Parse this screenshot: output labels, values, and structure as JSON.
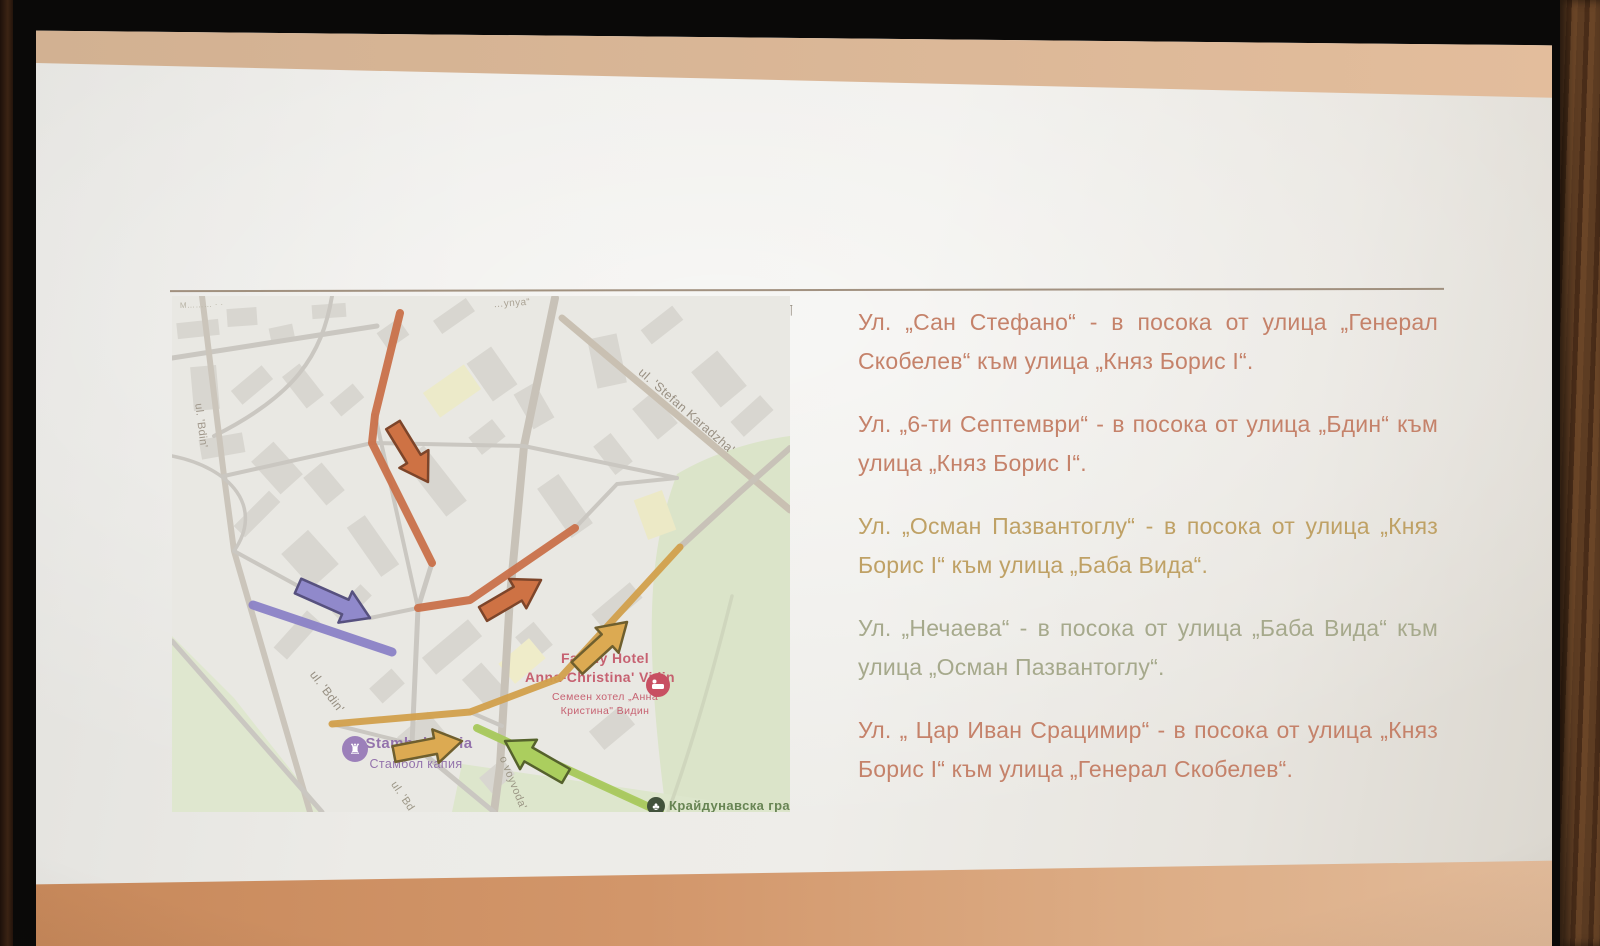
{
  "slide": {
    "paragraphs": [
      {
        "text": "Ул. „Сан Стефано“ - в посока от улица „Генерал Скобелев“ към улица „Княз Борис I“.",
        "color": "#c5826a"
      },
      {
        "text": "Ул. „6-ти Септември“ - в посока от улица „Бдин“ към улица „Княз Борис I“.",
        "color": "#c5826a"
      },
      {
        "text": "Ул. „Осман Пазвантоглу“  - в посока от улица „Княз Борис I“ към улица „Баба Вида“.",
        "color": "#bfa165"
      },
      {
        "text": "Ул. „Нечаева“ - в посока от улица „Баба Вида“ към улица „Осман Пазвантоглу“.",
        "color": "#a6a98c"
      },
      {
        "text": "Ул. „ Цар Иван Срацимир“ - в посока от улица „Княз Борис I“ към улица „Генерал Скобелев“.",
        "color": "#c5826a"
      }
    ],
    "pilcrow": "¶",
    "rule_color": "#93806c"
  },
  "map": {
    "labels": [
      {
        "text": "M………  ·  ·",
        "x": 8,
        "y": 12,
        "rot": -2,
        "size": 8,
        "color": "#b3ae9f",
        "anchor": "start"
      },
      {
        "text": "…ynya“",
        "x": 340,
        "y": 10,
        "rot": -4,
        "size": 10,
        "color": "#a59d8e"
      },
      {
        "text": "ul. 'Bdin'",
        "x": 26,
        "y": 130,
        "rot": 83,
        "size": 11,
        "color": "#9b9285"
      },
      {
        "text": "ul. 'Bdin'",
        "x": 152,
        "y": 398,
        "rot": 53,
        "size": 12,
        "color": "#8f8779"
      },
      {
        "text": "ul. 'Stefan Karadzha'",
        "x": 512,
        "y": 118,
        "rot": 41,
        "size": 12.5,
        "color": "#93897b"
      },
      {
        "text": "o voyvoda'",
        "x": 338,
        "y": 488,
        "rot": 68,
        "size": 11,
        "color": "#96907f"
      },
      {
        "text": "ul. 'Bd",
        "x": 228,
        "y": 502,
        "rot": 56,
        "size": 11,
        "color": "#96907f"
      },
      {
        "text": "Family Hotel",
        "x": 433,
        "y": 367,
        "rot": 0,
        "size": 14,
        "color": "#c45668",
        "weight": "bold"
      },
      {
        "text": "Anna-Christina' Vidin",
        "x": 428,
        "y": 386,
        "rot": 0,
        "size": 14,
        "color": "#c45668",
        "weight": "bold"
      },
      {
        "text": "Семеен хотел „Анна",
        "x": 433,
        "y": 404,
        "rot": 0,
        "size": 10.5,
        "color": "#c45668"
      },
      {
        "text": "Кристина\" Видин",
        "x": 433,
        "y": 418,
        "rot": 0,
        "size": 10.5,
        "color": "#c45668"
      },
      {
        "text": "Stambol kapia",
        "x": 247,
        "y": 452,
        "rot": 0,
        "size": 15,
        "color": "#8d6aa8",
        "weight": "bold"
      },
      {
        "text": "Стамбол капия",
        "x": 244,
        "y": 472,
        "rot": 0,
        "size": 12.5,
        "color": "#8d6aa8"
      },
      {
        "text": "Крайдунавска град",
        "x": 497,
        "y": 514,
        "rot": 0,
        "size": 13,
        "color": "#5e7c49",
        "weight": "bold",
        "anchor": "start"
      }
    ],
    "routes": [
      {
        "name": "san-stefano",
        "points": [
          [
            228,
            17
          ],
          [
            203,
            119
          ],
          [
            200,
            147
          ],
          [
            260,
            267
          ]
        ],
        "color": "#c9714a",
        "w": 8
      },
      {
        "name": "6-ti-septemvri",
        "points": [
          [
            246,
            312
          ],
          [
            298,
            304
          ],
          [
            403,
            232
          ]
        ],
        "color": "#c9714a",
        "w": 8
      },
      {
        "name": "tsar-ivan-sratsimir",
        "points": [
          [
            81,
            309
          ],
          [
            220,
            356
          ]
        ],
        "color": "#8b82c6",
        "w": 9
      },
      {
        "name": "osman-pazvantoglu",
        "points": [
          [
            160,
            428
          ],
          [
            298,
            416
          ],
          [
            388,
            382
          ],
          [
            508,
            251
          ]
        ],
        "color": "#d2a04c",
        "w": 7
      },
      {
        "name": "nechaeva",
        "points": [
          [
            305,
            432
          ],
          [
            488,
            516
          ]
        ],
        "color": "#a8c95c",
        "w": 8
      }
    ],
    "arrows": [
      {
        "from": [
          221,
          129
        ],
        "to": [
          256,
          186
        ],
        "fill": "#ce7244",
        "stroke": "#7d452a"
      },
      {
        "from": [
          311,
          318
        ],
        "to": [
          369,
          284
        ],
        "fill": "#ce7244",
        "stroke": "#7d452a"
      },
      {
        "from": [
          126,
          290
        ],
        "to": [
          198,
          322
        ],
        "fill": "#9089cb",
        "stroke": "#57517f"
      },
      {
        "from": [
          405,
          372
        ],
        "to": [
          455,
          326
        ],
        "fill": "#dcaa52",
        "stroke": "#6f5f2e"
      },
      {
        "from": [
          222,
          458
        ],
        "to": [
          290,
          445
        ],
        "fill": "#dcaa52",
        "stroke": "#6f5f2e"
      },
      {
        "from": [
          394,
          480
        ],
        "to": [
          333,
          445
        ],
        "fill": "#abce5e",
        "stroke": "#55622c"
      }
    ],
    "poi": [
      {
        "name": "hotel-pin",
        "x": 486,
        "y": 389,
        "r": 12,
        "fill": "#c85062",
        "type": "bed"
      },
      {
        "name": "kapia-pin",
        "x": 183,
        "y": 453,
        "r": 13,
        "fill": "#9c80ba",
        "type": "rook"
      },
      {
        "name": "park-pin",
        "x": 484,
        "y": 510,
        "r": 9,
        "fill": "#42523c",
        "type": "tree"
      }
    ]
  }
}
